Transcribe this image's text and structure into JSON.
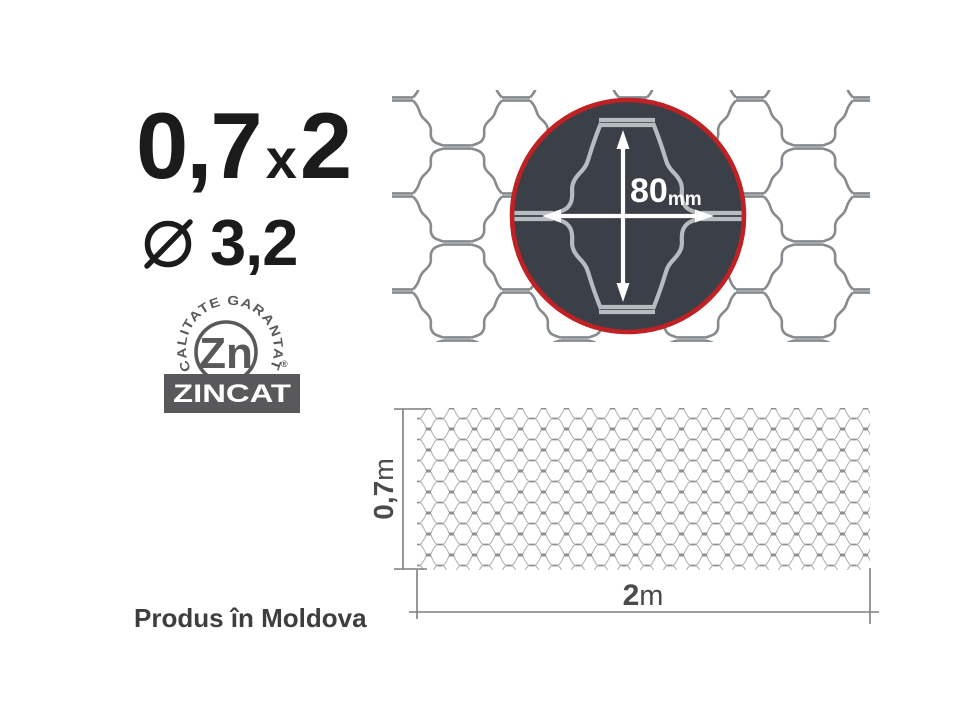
{
  "title": {
    "height": "0,7",
    "separator": "x",
    "length": "2"
  },
  "diameter": {
    "value": "3,2"
  },
  "badge": {
    "ring_text": "CALITATE GARANTATĂ",
    "element": "Zn",
    "registered": "®",
    "label": "ZINCAT"
  },
  "magnifier": {
    "cell_size": "80",
    "unit": "mm"
  },
  "sample": {
    "height": "0,7",
    "height_unit": "m",
    "width": "2",
    "width_unit": "m"
  },
  "footer": {
    "origin": "Produs în Moldova"
  },
  "colors": {
    "accent_red": "#bf2125",
    "magnifier_background": "#3b3f47",
    "wire_gray": "#858b8f",
    "badge_gray": "#59595b",
    "text_dark": "#1b1b1b"
  }
}
